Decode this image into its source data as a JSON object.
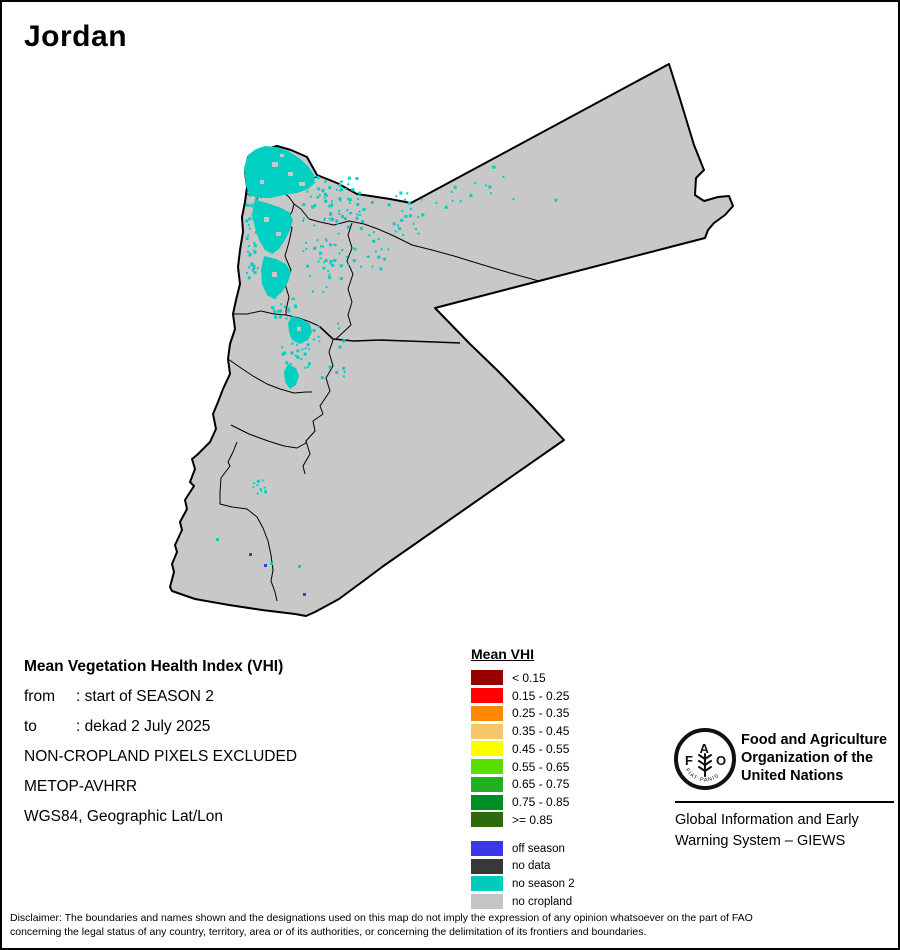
{
  "title": "Jordan",
  "info": {
    "heading": "Mean Vegetation Health Index (VHI)",
    "from_label": "from",
    "from_value": ": start of SEASON 2",
    "to_label": "to",
    "to_value": ": dekad 2 July 2025",
    "line4": "NON-CROPLAND PIXELS EXCLUDED",
    "line5": "METOP-AVHRR",
    "line6": "WGS84, Geographic Lat/Lon"
  },
  "legend": {
    "title": "Mean VHI",
    "vhi_classes": [
      {
        "label": "< 0.15",
        "color": "#990000"
      },
      {
        "label": "0.15 - 0.25",
        "color": "#FF0000"
      },
      {
        "label": "0.25 - 0.35",
        "color": "#FF8800"
      },
      {
        "label": "0.35 - 0.45",
        "color": "#F7C56C"
      },
      {
        "label": "0.45 - 0.55",
        "color": "#FFFF00"
      },
      {
        "label": "0.55 - 0.65",
        "color": "#55E000"
      },
      {
        "label": "0.65 - 0.75",
        "color": "#22B022"
      },
      {
        "label": "0.75 - 0.85",
        "color": "#008E23"
      },
      {
        "label": ">= 0.85",
        "color": "#2D6A0E"
      }
    ],
    "other_classes": [
      {
        "label": "off season",
        "color": "#3939E8"
      },
      {
        "label": "no data",
        "color": "#383838"
      },
      {
        "label": "no season 2",
        "color": "#00CCBE"
      },
      {
        "label": "no cropland",
        "color": "#C4C4C4"
      }
    ]
  },
  "fao": {
    "org_lines": [
      "Food and Agriculture",
      "Organization of the",
      "United Nations"
    ],
    "giews_lines": [
      "Global Information and Early",
      "Warning System – GIEWS"
    ],
    "logo_letters": [
      "F",
      "A",
      "O"
    ],
    "logo_motto": "FIAT·PANIS"
  },
  "disclaimer": {
    "line1": "Disclaimer: The boundaries and names shown and the designations used on this map do not imply the expression of any opinion whatsoever on the part of FAO",
    "line2": "concerning the legal status of any country, territory, area or of its authorities, or concerning the delimitation of its frontiers and boundaries."
  },
  "map": {
    "land_color": "#C8C8C8",
    "border_color": "#000000",
    "no_season2_color": "#00CFC2",
    "off_season_color": "#3939E8",
    "background_color": "#FFFFFF"
  }
}
